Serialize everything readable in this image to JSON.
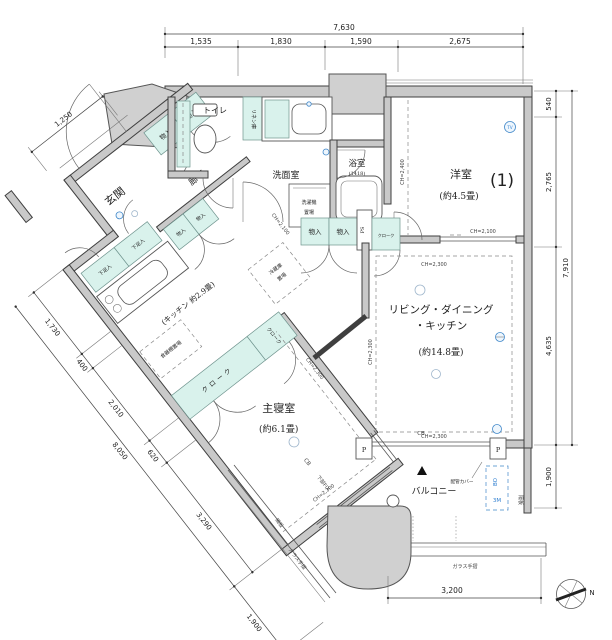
{
  "plan": {
    "rooms": {
      "genkan": "玄関",
      "rouka": "廊下",
      "toilet": "トイレ",
      "linen": "リネン庫",
      "senmen": "洗面室",
      "washer1": "洗濯機",
      "washer2": "置場",
      "bath": "浴室",
      "bath_size": "(1418)",
      "yoshitsu": "洋室",
      "yoshitsu_no": "(1)",
      "yoshitsu_size": "(約4.5畳)",
      "ldk1": "リビング・ダイニング",
      "ldk2": "・キッチン",
      "ldk_size": "(約14.8畳)",
      "kitchen": "(キッチン 約2.9畳)",
      "shokki": "食器棚置場",
      "reizo1": "冷蔵庫",
      "reizo2": "置場",
      "cloak": "クローク",
      "bedroom": "主寝室",
      "bedroom_size": "(約6.1畳)",
      "balcony": "バルコニー"
    },
    "storage": {
      "monoire": "物入",
      "geta": "下足入",
      "ps": "PS"
    },
    "annot": {
      "ch2300": "CH=2,300",
      "ch2100": "CH=2,100",
      "ch2400": "CH=2,400",
      "cb": "CB",
      "p": "P",
      "bo": "BO",
      "m3": "3M",
      "haikan": "配管カバー",
      "kakuita": "隔板",
      "glass": "ガラス手摺",
      "fix": "下部FIX",
      "tv": "TV",
      "north": "N"
    },
    "dims": {
      "top_total": "7,630",
      "top": [
        "1,535",
        "1,830",
        "1,590",
        "2,675"
      ],
      "right": [
        "540",
        "2,765",
        "4,635"
      ],
      "right_total": "7,910",
      "right_bottom": "1,900",
      "left_top": "1,250",
      "left": [
        "1,730",
        "400",
        "2,010",
        "620",
        "3,290"
      ],
      "left_total": "8,050",
      "left_bottom": "1,900",
      "bottom": "3,200"
    },
    "colors": {
      "closet_teal": "#d9f2ec",
      "wall_gray": "#c9c9c9",
      "accent_blue": "#2f7fd0"
    }
  }
}
